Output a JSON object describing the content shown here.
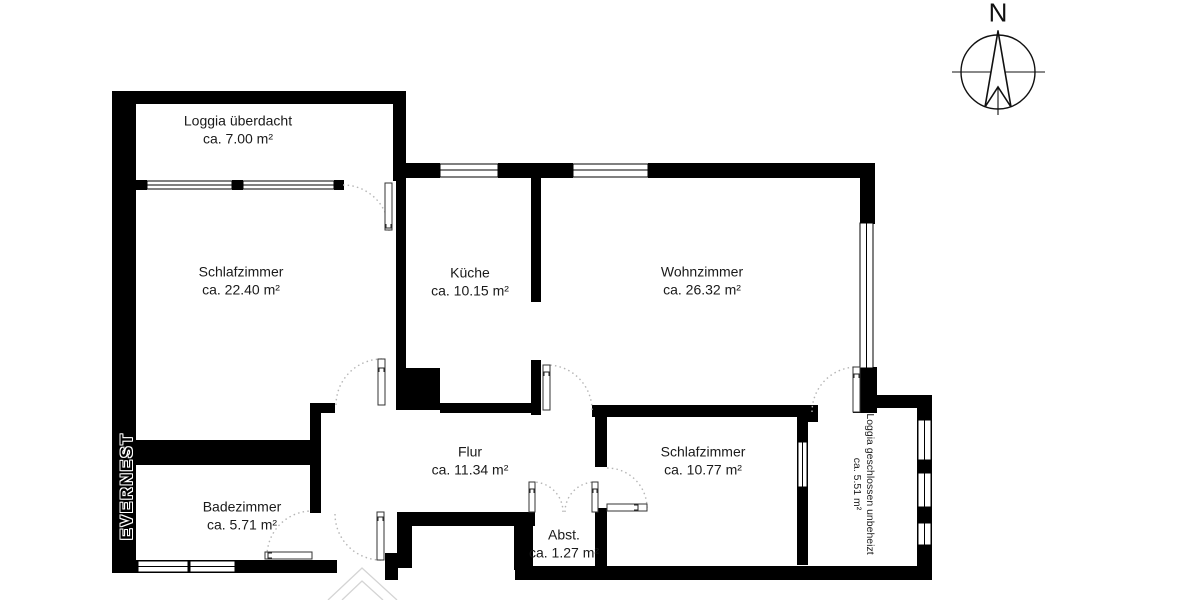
{
  "watermark": {
    "brand": "EVERNEST"
  },
  "compass": {
    "north_label": "N"
  },
  "rooms": [
    {
      "key": "loggia-ueberdacht",
      "name": "Loggia überdacht",
      "area": "ca. 7.00 m²"
    },
    {
      "key": "schlafzimmer-gross",
      "name": "Schlafzimmer",
      "area": "ca. 22.40 m²"
    },
    {
      "key": "kueche",
      "name": "Küche",
      "area": "ca. 10.15 m²"
    },
    {
      "key": "wohnzimmer",
      "name": "Wohnzimmer",
      "area": "ca. 26.32 m²"
    },
    {
      "key": "flur",
      "name": "Flur",
      "area": "ca. 11.34 m²"
    },
    {
      "key": "schlafzimmer-klein",
      "name": "Schlafzimmer",
      "area": "ca. 10.77 m²"
    },
    {
      "key": "badezimmer",
      "name": "Badezimmer",
      "area": "ca. 5.71 m²"
    },
    {
      "key": "abstellraum",
      "name": "Abst.",
      "area": "ca. 1.27 m²"
    },
    {
      "key": "loggia-geschlossen",
      "name": "Loggia geschlossen unbeheizt",
      "area": "ca. 5.51 m²"
    }
  ],
  "colors": {
    "wall": "#000000",
    "background": "#ffffff",
    "door_arc": "#b5b5b5",
    "label_text": "#1a1a1a"
  }
}
